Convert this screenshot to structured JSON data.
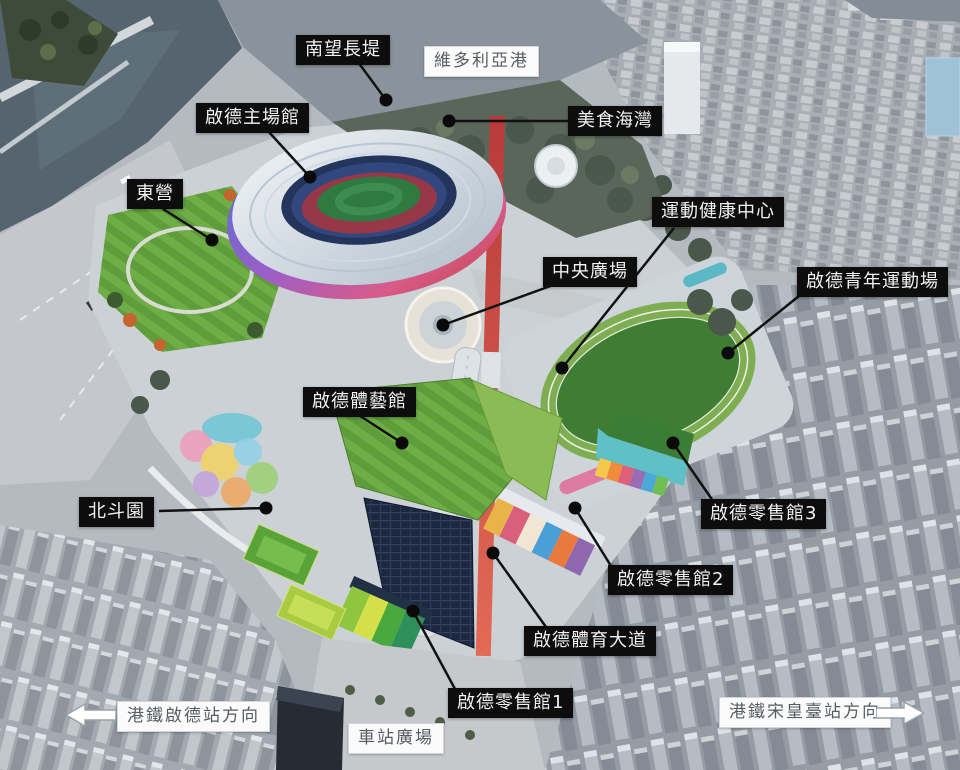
{
  "colors": {
    "facility_label_bg": "#0d0d0d",
    "facility_label_text": "#f2f2f2",
    "info_label_bg": "#fbfbfb",
    "info_label_text": "#575c62",
    "leader_line": "#111111",
    "harbour_water": "#8a929b",
    "channel_water": "#55646e",
    "lawn_green": "#5f9c3b",
    "track_green": "#3e7d33",
    "avenue_red": "#c64040",
    "solar_roof_navy": "#1c2840",
    "stadium_rim_purple": "#9a5fc8"
  },
  "labels": {
    "promenade": {
      "text": "南望長堤"
    },
    "harbour": {
      "text": "維多利亞港"
    },
    "stadium": {
      "text": "啟德主場館"
    },
    "food_bay": {
      "text": "美食海灣"
    },
    "east_camp": {
      "text": "東營"
    },
    "health_centre": {
      "text": "運動健康中心"
    },
    "central_plaza": {
      "text": "中央廣場"
    },
    "youth_sports_ground": {
      "text": "啟德青年運動場"
    },
    "arena": {
      "text": "啟德體藝館"
    },
    "north_star_garden": {
      "text": "北斗園"
    },
    "retail_hall_3": {
      "text": "啟德零售館3"
    },
    "retail_hall_2": {
      "text": "啟德零售館2"
    },
    "sports_avenue": {
      "text": "啟德體育大道"
    },
    "retail_hall_1": {
      "text": "啟德零售館1"
    },
    "station_square": {
      "text": "車站廣場"
    },
    "mtr_kai_tak_direction": {
      "text": "港鐵啟德站方向"
    },
    "mtr_sung_wong_toi_direction": {
      "text": "港鐵宋皇臺站方向"
    }
  }
}
